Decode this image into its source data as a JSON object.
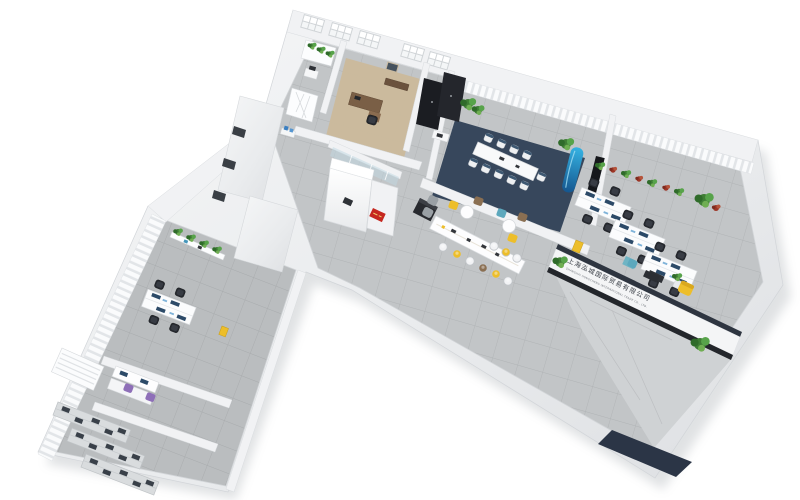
{
  "meta": {
    "type": "3d-floorplan-render",
    "view": "aerial axonometric",
    "background": "#ffffff"
  },
  "sign": {
    "company_name_zh": "上海泓城国际贸易有限公司",
    "company_name_en": "SHANGHAI HONGCHENG INTERNATIONAL TRADE CO., LTD.",
    "text_color": "#3b4048"
  },
  "colors": {
    "background": "#ffffff",
    "outer_wall": "#e9ebed",
    "carpet_main": "#c2c5c7",
    "carpet_left_wing": "#babdbf",
    "conference_rug": "#37475c",
    "wood_floor": "#cbb99b",
    "wood_desk": "#7a5f46",
    "black_furniture": "#1b1d22",
    "accent_yellow": "#edbe2a",
    "accent_teal": "#5da8bd",
    "accent_blue": "#1f86c9",
    "accent_purple": "#8e6fb8",
    "logo_red": "#c5271f",
    "plant_green": "#4a8f3f",
    "plant_red": "#a8392a",
    "entrance_mat": "#2b3546",
    "monitor_navy": "#2c4a68"
  },
  "scene": {
    "building": "L-shaped office with two wings, white outer walls, seen from above at an angle",
    "rooms": [
      {
        "name": "pantry-corner",
        "items": "white shelf with small plants, printer table, lattice screen"
      },
      {
        "name": "manager-office",
        "items": "wood floor, brown executive desk and chair, wall picture, windows"
      },
      {
        "name": "wardrobe-room",
        "items": "two black storage cabinets, window, plant, small laptop desk"
      },
      {
        "name": "conference-room",
        "items": "navy rug, long white 10-seat table, white chairs, curtain wall, two plants, dark wall screen, blue banner"
      },
      {
        "name": "break-area",
        "items": "long white bar table with 9 stools (white, yellow, brown), black kitchen unit, two round tables with yellow, blue and brown chairs, two gray lounge chairs"
      },
      {
        "name": "open-office",
        "items": "three shared desk benches with monitors and black chairs, green and red wall plants, curtains"
      },
      {
        "name": "reception",
        "items": "white L-shaped desk with red logo sign, corridor with three doors, washroom with blue fixture"
      },
      {
        "name": "front-counter",
        "items": "long white counter with dark cap, company name lettering, plants at both ends, yellow armchair, teal chair, dark side table"
      },
      {
        "name": "entrance",
        "items": "tiled walkway leading to corner door, dark navy floor mat"
      },
      {
        "name": "team-office-left-wing",
        "items": "desk bench with monitors and four black chairs, wall shelf with four plants, curtain wall, yellow cabinet"
      },
      {
        "name": "print-area-left-wing",
        "items": "two white desks with two purple chairs"
      },
      {
        "name": "archive-room-left-wing",
        "items": "three metal shelving racks with dark boxes, window blinds"
      }
    ]
  }
}
